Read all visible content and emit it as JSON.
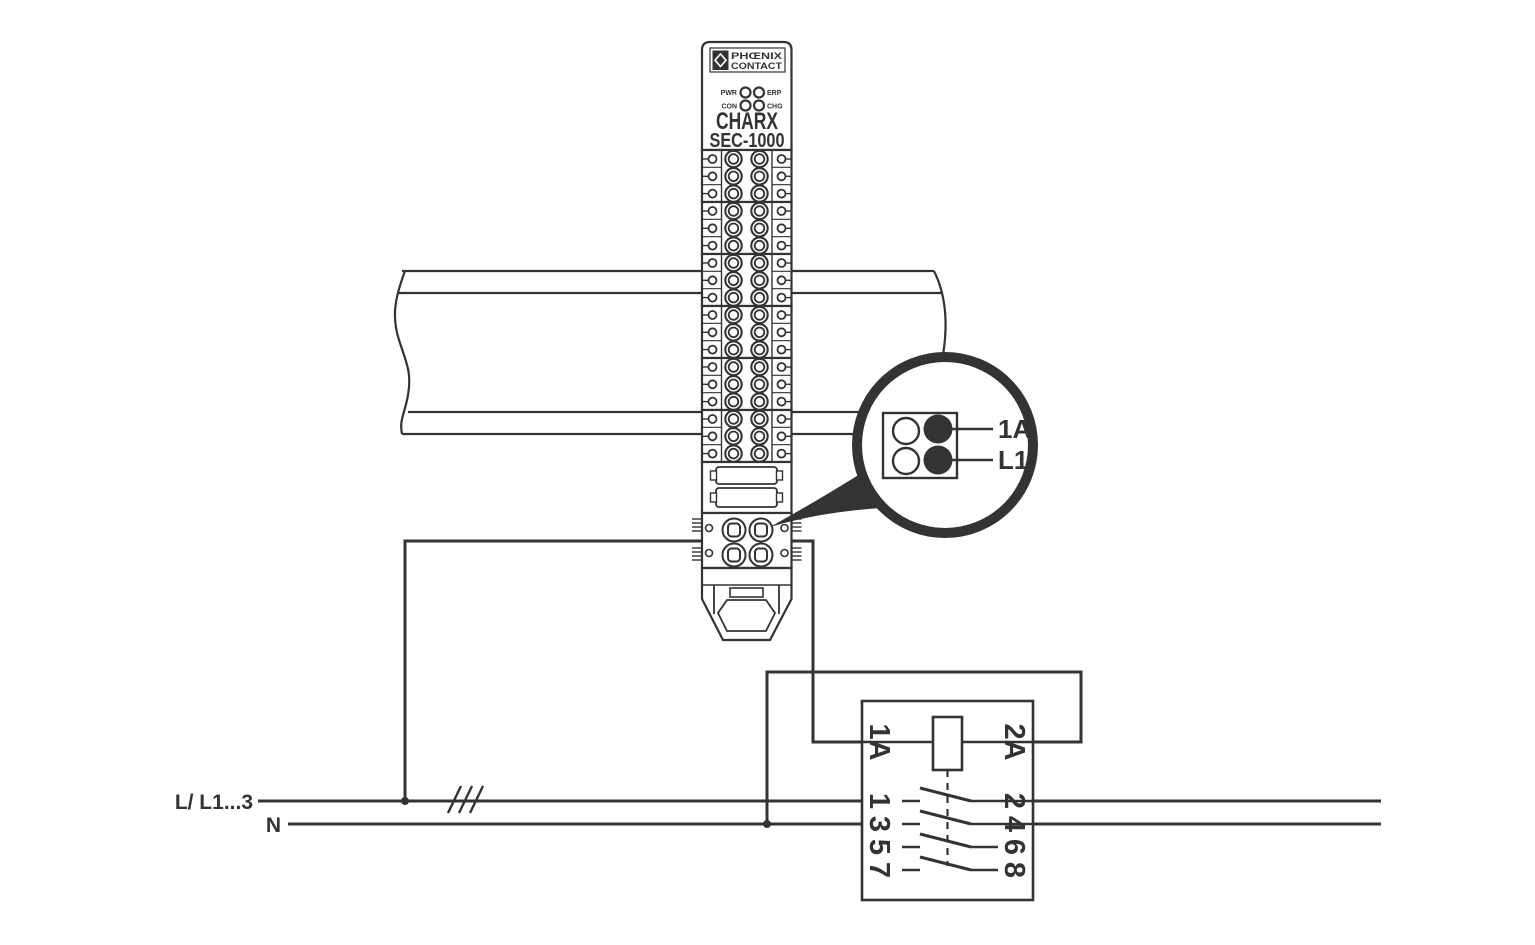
{
  "diagram": {
    "title_hint": "CHARX SEC-1000 supply wiring diagram",
    "device": {
      "brand_line1": "PHŒNIX",
      "brand_line2": "CONTACT",
      "leds": [
        "PWR",
        "ERP",
        "CON",
        "CHG"
      ],
      "model_line1": "CHARX",
      "model_line2": "SEC-1000"
    },
    "callout": {
      "labels": [
        "1A",
        "L1"
      ]
    },
    "supply": {
      "phase_label": "L/ L1...3",
      "neutral_label": "N"
    },
    "contactor": {
      "coil_terminals": [
        "1A",
        "2A"
      ],
      "input_terminals": [
        "1",
        "3",
        "5",
        "7"
      ],
      "output_terminals": [
        "2",
        "4",
        "6",
        "8"
      ]
    },
    "colors": {
      "ink": "#333333",
      "background": "#ffffff"
    }
  }
}
